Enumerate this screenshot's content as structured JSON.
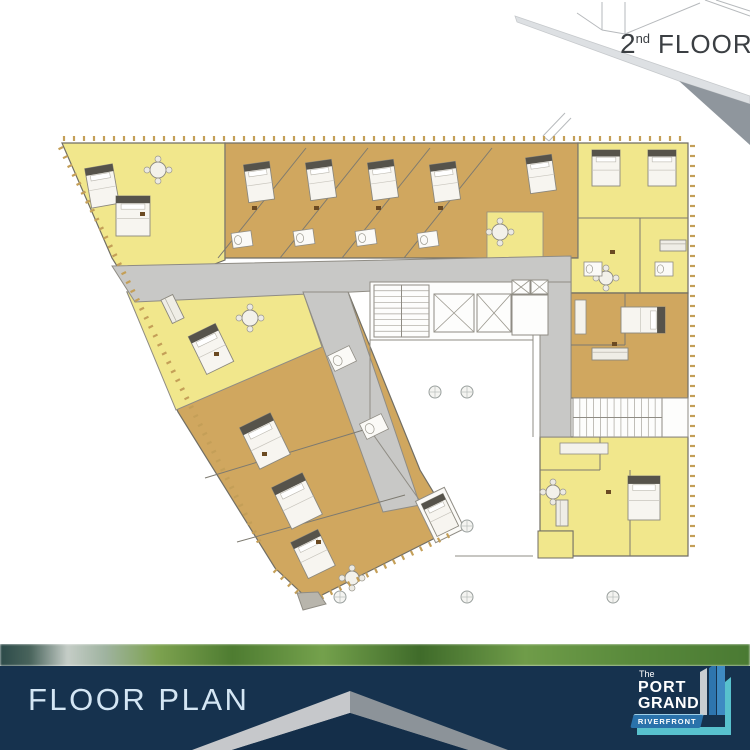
{
  "badge": {
    "number": "2",
    "suffix": "nd",
    "word": "FLOOR"
  },
  "footer": {
    "title": "FLOOR PLAN",
    "logo": {
      "line0": "The",
      "line1": "PORT",
      "line2": "GRAND",
      "ribbon": "RIVERFRONT"
    }
  },
  "palette": {
    "unit_yellow": "#f1e78c",
    "unit_tan": "#d0a75f",
    "corridor_gray": "#c8c8c6",
    "wall": "#716e64",
    "navy": "#16324e",
    "chevron_light": "#c6c8cb",
    "chevron_dark": "#8c9399",
    "title_text": "#d4e6f4",
    "ribbon_blue": "#2a72ab",
    "teal": "#58c1cd",
    "slab_light": "#dde0e3",
    "slab_dark": "#8f969d",
    "balcony_tick": "#c49f58"
  },
  "plan": {
    "shapes": [
      {
        "n": "slab-top-face",
        "t": "poly",
        "pts": "515,16 750,96 750,104 679,81 517,22",
        "f": "#dde0e3",
        "s": "#c6c9cc",
        "w": 0.8
      },
      {
        "n": "slab-front-face",
        "t": "poly",
        "pts": "679,81 750,104 750,145",
        "f": "#8f969d"
      },
      {
        "n": "wireframe-line",
        "t": "line",
        "p": [
          602,
          2,
          602,
          30
        ]
      },
      {
        "n": "wireframe-line",
        "t": "line",
        "p": [
          625,
          2,
          625,
          34
        ]
      },
      {
        "n": "wireframe-line",
        "t": "line",
        "p": [
          602,
          30,
          625,
          34
        ]
      },
      {
        "n": "wireframe-line",
        "t": "line",
        "p": [
          602,
          30,
          577,
          13
        ]
      },
      {
        "n": "wireframe-line",
        "t": "line",
        "p": [
          625,
          34,
          700,
          3
        ]
      },
      {
        "n": "wireframe-line",
        "t": "line",
        "p": [
          705,
          0,
          750,
          16
        ]
      },
      {
        "n": "wireframe-line",
        "t": "line",
        "p": [
          716,
          0,
          750,
          11
        ]
      },
      {
        "n": "ghost-outline-line",
        "t": "line",
        "p": [
          543,
          136,
          565,
          113
        ]
      },
      {
        "n": "ghost-outline-line",
        "t": "line",
        "p": [
          549,
          141,
          571,
          118
        ]
      },
      {
        "n": "ghost-outline-line",
        "t": "line",
        "p": [
          543,
          136,
          549,
          141
        ]
      },
      {
        "n": "unit-top-left-yellow",
        "t": "poly",
        "pts": "62,143 225,143 225,260 135,295 112,258",
        "f": "#f1e78c",
        "s": "#716e64",
        "w": 1.2
      },
      {
        "n": "unit-top-tan",
        "t": "poly",
        "pts": "225,143 578,143 578,258 225,258",
        "f": "#d0a75f",
        "s": "#716e64",
        "w": 1.2
      },
      {
        "n": "unit-pocket-yellow",
        "t": "poly",
        "pts": "487,212 543,212 543,258 487,258",
        "f": "#f1e78c",
        "s": "#8f8c84",
        "w": 0.8
      },
      {
        "n": "unit-top-right-yellow",
        "t": "poly",
        "pts": "578,143 688,143 688,293 571,293 571,258 578,258",
        "f": "#f1e78c",
        "s": "#716e64",
        "w": 1.2
      },
      {
        "n": "unit-right-tan",
        "t": "poly",
        "pts": "571,293 688,293 688,398 571,398",
        "f": "#d0a75f",
        "s": "#716e64",
        "w": 1.2
      },
      {
        "n": "unit-wing-tan",
        "t": "poly",
        "pts": "127,292 348,292 420,470 455,528 310,601 275,568 178,412",
        "f": "#d0a75f",
        "s": "#716e64",
        "w": 1.2
      },
      {
        "n": "unit-wing-yellow",
        "t": "poly",
        "pts": "127,292 303,292 322,347 176,410",
        "f": "#f1e78c",
        "s": "#8f8c84",
        "w": 1
      },
      {
        "n": "unit-bottom-right-yellow",
        "t": "poly",
        "pts": "540,437 688,437 688,556 573,556 573,531 540,531",
        "f": "#f1e78c",
        "s": "#716e64",
        "w": 1.2
      },
      {
        "n": "unit-bottom-right-notch",
        "t": "poly",
        "pts": "538,531 573,531 573,558 538,558",
        "f": "#f1e78c",
        "s": "#716e64",
        "w": 1
      },
      {
        "n": "corridor-main",
        "t": "poly",
        "pts": "112,266 571,256 571,282 135,302",
        "f": "#c8c8c6",
        "s": "#8f8c84",
        "w": 1
      },
      {
        "n": "corridor-right",
        "t": "poly",
        "pts": "540,282 571,282 571,437 540,437",
        "f": "#c8c8c6",
        "s": "#8f8c84",
        "w": 1
      },
      {
        "n": "corridor-wing",
        "t": "poly",
        "pts": "303,292 348,292 420,505 383,512",
        "f": "#c8c8c6",
        "s": "#8f8c84",
        "w": 1
      },
      {
        "n": "core-room",
        "t": "rect",
        "x": 370,
        "y": 282,
        "w": 163,
        "h": 58,
        "f": "#fdfdfc",
        "s": "#8f8c84",
        "sw": 1
      },
      {
        "n": "stair-main",
        "t": "stairH",
        "x": 374,
        "y": 285,
        "w": 55,
        "h": 52,
        "nn": 9
      },
      {
        "n": "elevator-1",
        "t": "elev",
        "x": 434,
        "y": 294,
        "w": 40,
        "h": 38
      },
      {
        "n": "elevator-2",
        "t": "elev",
        "x": 477,
        "y": 294,
        "w": 34,
        "h": 38
      },
      {
        "n": "shaft-1",
        "t": "elev",
        "x": 512,
        "y": 280,
        "w": 18,
        "h": 14
      },
      {
        "n": "shaft-2",
        "t": "elev",
        "x": 531,
        "y": 280,
        "w": 17,
        "h": 14
      },
      {
        "n": "lobby-room",
        "t": "rect",
        "x": 512,
        "y": 295,
        "w": 36,
        "h": 40,
        "f": "#fdfdfc",
        "s": "#8f8c84",
        "sw": 1
      },
      {
        "n": "void-wall",
        "t": "line",
        "p": [
          370,
          340,
          370,
          430
        ],
        "s": "#8f8c84",
        "w": 1
      },
      {
        "n": "void-wall",
        "t": "line",
        "p": [
          370,
          430,
          425,
          508
        ],
        "s": "#8f8c84",
        "w": 1
      },
      {
        "n": "void-wall",
        "t": "line",
        "p": [
          533,
          340,
          533,
          437
        ],
        "s": "#8f8c84",
        "w": 1
      },
      {
        "n": "void-wall",
        "t": "line",
        "p": [
          455,
          556,
          533,
          556
        ],
        "s": "#8f8c84",
        "w": 1
      },
      {
        "n": "room-white-wing",
        "t": "rect",
        "x": 424,
        "y": 492,
        "w": 32,
        "h": 46,
        "rot": -26,
        "f": "#fbfaf7",
        "s": "#8f8c84",
        "sw": 1
      },
      {
        "n": "stair-secondary",
        "t": "stairV",
        "x": 573,
        "y": 398,
        "w": 89,
        "h": 39,
        "nn": 13
      },
      {
        "n": "room-white-right",
        "t": "rect",
        "x": 662,
        "y": 398,
        "w": 26,
        "h": 39,
        "f": "#fdfdfc",
        "s": "#8f8c84",
        "sw": 1
      },
      {
        "n": "wall",
        "t": "line",
        "p": [
          225,
          143,
          225,
          258
        ],
        "s": "#7d7a70",
        "w": 1
      },
      {
        "n": "wall",
        "t": "line",
        "p": [
          218,
          258,
          306,
          148
        ],
        "s": "#7d7a70",
        "w": 1
      },
      {
        "n": "wall",
        "t": "line",
        "p": [
          280,
          258,
          368,
          148
        ],
        "s": "#7d7a70",
        "w": 1
      },
      {
        "n": "wall",
        "t": "line",
        "p": [
          342,
          258,
          430,
          148
        ],
        "s": "#7d7a70",
        "w": 1
      },
      {
        "n": "wall",
        "t": "line",
        "p": [
          404,
          258,
          492,
          148
        ],
        "s": "#7d7a70",
        "w": 1
      },
      {
        "n": "wall",
        "t": "line",
        "p": [
          578,
          143,
          578,
          258
        ],
        "s": "#7d7a70",
        "w": 1
      },
      {
        "n": "wall",
        "t": "line",
        "p": [
          578,
          218,
          688,
          218
        ],
        "s": "#7d7a70",
        "w": 1
      },
      {
        "n": "wall",
        "t": "line",
        "p": [
          640,
          218,
          640,
          293
        ],
        "s": "#7d7a70",
        "w": 1
      },
      {
        "n": "wall",
        "t": "line",
        "p": [
          625,
          293,
          625,
          345
        ],
        "s": "#7d7a70",
        "w": 1
      },
      {
        "n": "wall",
        "t": "line",
        "p": [
          571,
          345,
          625,
          345
        ],
        "s": "#7d7a70",
        "w": 1
      },
      {
        "n": "wall",
        "t": "line",
        "p": [
          205,
          478,
          370,
          428
        ],
        "s": "#7d7a70",
        "w": 1
      },
      {
        "n": "wall",
        "t": "line",
        "p": [
          237,
          542,
          405,
          495
        ],
        "s": "#7d7a70",
        "w": 1
      },
      {
        "n": "wall",
        "t": "line",
        "p": [
          540,
          470,
          600,
          470
        ],
        "s": "#7d7a70",
        "w": 1
      },
      {
        "n": "wall",
        "t": "line",
        "p": [
          600,
          437,
          600,
          470
        ],
        "s": "#7d7a70",
        "w": 1
      },
      {
        "n": "wall",
        "t": "line",
        "p": [
          630,
          470,
          630,
          556
        ],
        "s": "#7d7a70",
        "w": 1
      },
      {
        "n": "bed",
        "t": "bed",
        "x": 88,
        "y": 166,
        "w": 28,
        "h": 40,
        "rot": -10
      },
      {
        "n": "bed",
        "t": "bed",
        "x": 116,
        "y": 196,
        "w": 34,
        "h": 40,
        "rot": 0
      },
      {
        "n": "bed",
        "t": "bed",
        "x": 246,
        "y": 163,
        "w": 26,
        "h": 38,
        "rot": -8
      },
      {
        "n": "bed",
        "t": "bed",
        "x": 308,
        "y": 161,
        "w": 26,
        "h": 38,
        "rot": -8
      },
      {
        "n": "bed",
        "t": "bed",
        "x": 370,
        "y": 161,
        "w": 26,
        "h": 38,
        "rot": -8
      },
      {
        "n": "bed",
        "t": "bed",
        "x": 432,
        "y": 163,
        "w": 26,
        "h": 38,
        "rot": -8
      },
      {
        "n": "bed",
        "t": "bed",
        "x": 528,
        "y": 156,
        "w": 26,
        "h": 36,
        "rot": -8
      },
      {
        "n": "bed",
        "t": "bed",
        "x": 592,
        "y": 150,
        "w": 28,
        "h": 36,
        "rot": 0
      },
      {
        "n": "bed",
        "t": "bed",
        "x": 648,
        "y": 150,
        "w": 28,
        "h": 36,
        "rot": 0
      },
      {
        "n": "bed",
        "t": "bed",
        "x": 630,
        "y": 298,
        "w": 26,
        "h": 44,
        "rot": 90
      },
      {
        "n": "bed",
        "t": "bed",
        "x": 628,
        "y": 476,
        "w": 32,
        "h": 44,
        "rot": 0
      },
      {
        "n": "bed",
        "t": "bed",
        "x": 196,
        "y": 328,
        "w": 30,
        "h": 42,
        "rot": -26
      },
      {
        "n": "bed",
        "t": "bed",
        "x": 248,
        "y": 418,
        "w": 34,
        "h": 46,
        "rot": -26
      },
      {
        "n": "bed",
        "t": "bed",
        "x": 280,
        "y": 478,
        "w": 34,
        "h": 46,
        "rot": -26
      },
      {
        "n": "bed",
        "t": "bed",
        "x": 298,
        "y": 534,
        "w": 30,
        "h": 40,
        "rot": -26
      },
      {
        "n": "bed",
        "t": "bed",
        "x": 428,
        "y": 497,
        "w": 24,
        "h": 36,
        "rot": -26
      },
      {
        "n": "dining-table",
        "t": "table",
        "cx": 158,
        "cy": 170,
        "r": 8
      },
      {
        "n": "dining-table",
        "t": "table",
        "cx": 250,
        "cy": 318,
        "r": 8
      },
      {
        "n": "dining-table",
        "t": "table",
        "cx": 500,
        "cy": 232,
        "r": 8
      },
      {
        "n": "dining-table",
        "t": "table",
        "cx": 606,
        "cy": 278,
        "r": 7
      },
      {
        "n": "dining-table",
        "t": "table",
        "cx": 553,
        "cy": 492,
        "r": 7
      },
      {
        "n": "dining-table",
        "t": "table",
        "cx": 352,
        "cy": 578,
        "r": 7
      },
      {
        "n": "sofa",
        "t": "sofa",
        "x": 166,
        "y": 296,
        "w": 13,
        "h": 26,
        "rot": -26
      },
      {
        "n": "sofa",
        "t": "sofa",
        "x": 592,
        "y": 348,
        "w": 36,
        "h": 12,
        "rot": 0
      },
      {
        "n": "sofa",
        "t": "sofa",
        "x": 556,
        "y": 500,
        "w": 12,
        "h": 26,
        "rot": 0
      },
      {
        "n": "sofa",
        "t": "sofa",
        "x": 660,
        "y": 240,
        "w": 26,
        "h": 11,
        "rot": 0
      },
      {
        "n": "bathroom",
        "t": "bath",
        "x": 232,
        "y": 232,
        "w": 20,
        "h": 15,
        "rot": -8
      },
      {
        "n": "bathroom",
        "t": "bath",
        "x": 294,
        "y": 230,
        "w": 20,
        "h": 15,
        "rot": -8
      },
      {
        "n": "bathroom",
        "t": "bath",
        "x": 356,
        "y": 230,
        "w": 20,
        "h": 15,
        "rot": -8
      },
      {
        "n": "bathroom",
        "t": "bath",
        "x": 418,
        "y": 232,
        "w": 20,
        "h": 15,
        "rot": -8
      },
      {
        "n": "bathroom",
        "t": "bath",
        "x": 584,
        "y": 262,
        "w": 18,
        "h": 14,
        "rot": 0
      },
      {
        "n": "bathroom",
        "t": "bath",
        "x": 655,
        "y": 262,
        "w": 18,
        "h": 14,
        "rot": 0
      },
      {
        "n": "bathroom",
        "t": "bath",
        "x": 330,
        "y": 350,
        "w": 24,
        "h": 17,
        "rot": -26
      },
      {
        "n": "bathroom",
        "t": "bath",
        "x": 362,
        "y": 418,
        "w": 24,
        "h": 17,
        "rot": -26
      },
      {
        "n": "kitchen-counter",
        "t": "rect",
        "x": 560,
        "y": 443,
        "w": 48,
        "h": 11,
        "f": "#f4f2ec",
        "s": "#8f8c84",
        "sw": 0.8
      },
      {
        "n": "kitchen-counter",
        "t": "rect",
        "x": 575,
        "y": 300,
        "w": 11,
        "h": 34,
        "f": "#f4f2ec",
        "s": "#8f8c84",
        "sw": 0.8
      },
      {
        "n": "column",
        "t": "circle",
        "cx": 435,
        "cy": 392,
        "r": 6
      },
      {
        "n": "column",
        "t": "circle",
        "cx": 467,
        "cy": 392,
        "r": 6
      },
      {
        "n": "column",
        "t": "circle",
        "cx": 467,
        "cy": 526,
        "r": 6
      },
      {
        "n": "column",
        "t": "circle",
        "cx": 340,
        "cy": 597,
        "r": 6
      },
      {
        "n": "column",
        "t": "circle",
        "cx": 467,
        "cy": 597,
        "r": 6
      },
      {
        "n": "column",
        "t": "circle",
        "cx": 613,
        "cy": 597,
        "r": 6
      },
      {
        "n": "balcony-ticks",
        "t": "ticks",
        "p": [
          64,
          141,
          576,
          141
        ],
        "step": 10,
        "len": 5
      },
      {
        "n": "balcony-ticks",
        "t": "ticks",
        "p": [
          580,
          141,
          687,
          141
        ],
        "step": 10,
        "len": 5
      },
      {
        "n": "balcony-ticks",
        "t": "ticks",
        "p": [
          63,
          147,
          263,
          544
        ],
        "step": 10,
        "len": 5,
        "flip": true
      },
      {
        "n": "balcony-ticks",
        "t": "ticks",
        "p": [
          690,
          146,
          690,
          554
        ],
        "step": 10,
        "len": 5
      },
      {
        "n": "balcony-ticks",
        "t": "ticks",
        "p": [
          312,
          599,
          454,
          530
        ],
        "step": 10,
        "len": 5,
        "flip": true
      },
      {
        "n": "balcony-ticks",
        "t": "ticks",
        "p": [
          277,
          569,
          308,
          599
        ],
        "step": 10,
        "len": 5,
        "flip": true
      },
      {
        "n": "wing-tip-block",
        "t": "poly",
        "pts": "297,593 318,592 326,604 303,610",
        "f": "#b8b5ac",
        "s": "#8f8c84",
        "w": 1
      },
      {
        "n": "unit-number-mark",
        "t": "dot",
        "x": 252,
        "y": 206
      },
      {
        "n": "unit-number-mark",
        "t": "dot",
        "x": 314,
        "y": 206
      },
      {
        "n": "unit-number-mark",
        "t": "dot",
        "x": 376,
        "y": 206
      },
      {
        "n": "unit-number-mark",
        "t": "dot",
        "x": 438,
        "y": 206
      },
      {
        "n": "unit-number-mark",
        "t": "dot",
        "x": 610,
        "y": 250
      },
      {
        "n": "unit-number-mark",
        "t": "dot",
        "x": 612,
        "y": 342
      },
      {
        "n": "unit-number-mark",
        "t": "dot",
        "x": 606,
        "y": 490
      },
      {
        "n": "unit-number-mark",
        "t": "dot",
        "x": 214,
        "y": 352
      },
      {
        "n": "unit-number-mark",
        "t": "dot",
        "x": 262,
        "y": 452
      },
      {
        "n": "unit-number-mark",
        "t": "dot",
        "x": 316,
        "y": 540
      },
      {
        "n": "unit-number-mark",
        "t": "dot",
        "x": 140,
        "y": 212
      }
    ]
  },
  "footer_shapes": [
    {
      "n": "chevron-left-arm",
      "t": "poly",
      "pts": "350,25 192,84 232,84 350,47",
      "f": "#c6c8cb"
    },
    {
      "n": "chevron-right-arm",
      "t": "poly",
      "pts": "350,25 508,84 468,84 350,47",
      "f": "#8c9399"
    },
    {
      "n": "chevron-inner-shadow",
      "t": "poly",
      "pts": "350,47 232,84 468,84",
      "f": "#142e49"
    }
  ],
  "logo_shapes": [
    {
      "n": "logo-bar-gray",
      "t": "poly",
      "pts": "76,14 83,10 83,57 76,57",
      "f": "#c9cdd1"
    },
    {
      "n": "logo-bar-blue-1",
      "t": "poly",
      "pts": "85,10 92,5 92,57 85,57",
      "f": "#2e75ae"
    },
    {
      "n": "logo-bar-blue-2",
      "t": "poly",
      "pts": "93,6 101,1 101,57 93,57",
      "f": "#3e8ac2"
    },
    {
      "n": "logo-frame-vertical",
      "t": "poly",
      "pts": "101,24 107,19 107,77 101,77",
      "f": "#58c1cd"
    },
    {
      "n": "logo-frame-horizontal",
      "t": "rect",
      "x": 13,
      "y": 69,
      "w": 94,
      "h": 8,
      "f": "#58c1cd"
    }
  ]
}
